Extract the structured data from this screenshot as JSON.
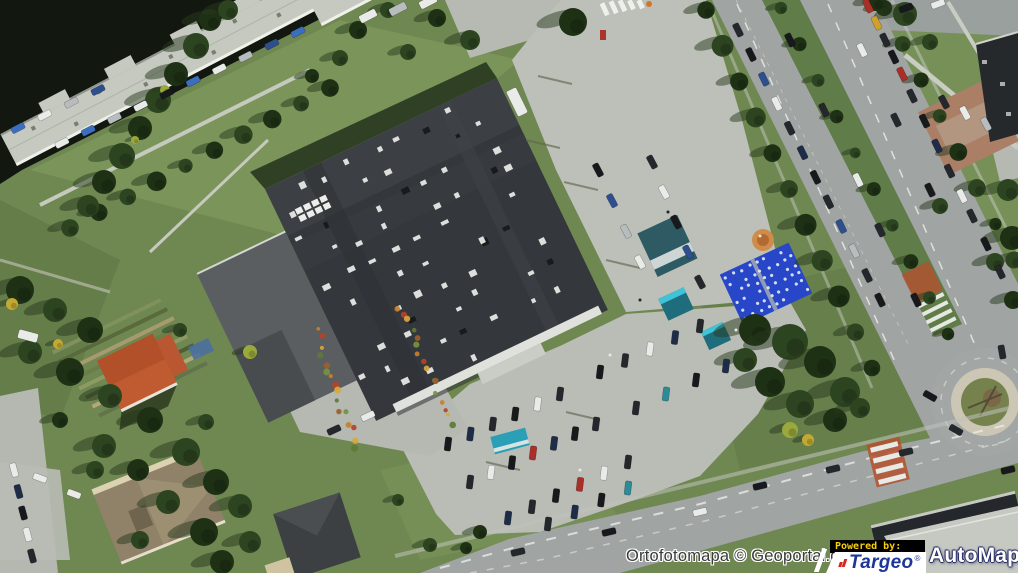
{
  "attribution": {
    "source": "Ortofotomapa © Geoportal.gov.pl"
  },
  "branding": {
    "powered_by": "Powered by:",
    "targeo": "Targeo",
    "automapa": "AutoMapa",
    "registered_mark": "®"
  },
  "colors": {
    "targeo_blue": "#1d3799",
    "targeo_red": "#d6281e",
    "powered_by_yellow": "#f7cf0a",
    "powered_by_bg": "#000000",
    "automapa_white": "#ffffff",
    "automapa_outline_navy": "#2a2f6a",
    "attribution_text": "#3a3a3a",
    "attribution_halo": "#ffffff"
  }
}
